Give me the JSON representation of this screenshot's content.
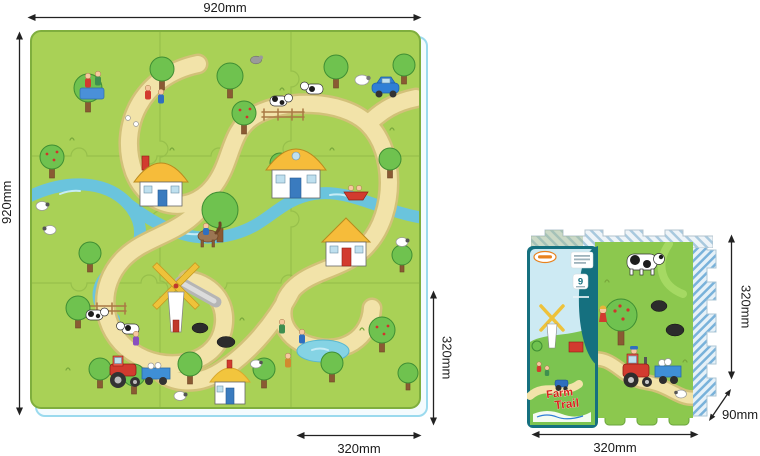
{
  "mat_diagram": {
    "width_label": "920mm",
    "height_label": "920mm",
    "tile_height_label": "320mm",
    "tile_width_label": "320mm"
  },
  "package_diagram": {
    "height_label": "320mm",
    "depth_label": "90mm",
    "width_label": "320mm",
    "piece_count": "9",
    "sleeve_title_line1": "Farm",
    "sleeve_title_line2": "Trail"
  },
  "colors": {
    "mat_green": "#a9d156",
    "face_green": "#8cc84e",
    "road": "#f2e3a9",
    "river": "#6ac4dd",
    "sleeve_teal": "#15707f",
    "roof_yellow": "#f6bc3a",
    "tractor_red": "#d23b2f",
    "dimension_line": "#222222",
    "stack_shadow": "#9bdaee"
  }
}
